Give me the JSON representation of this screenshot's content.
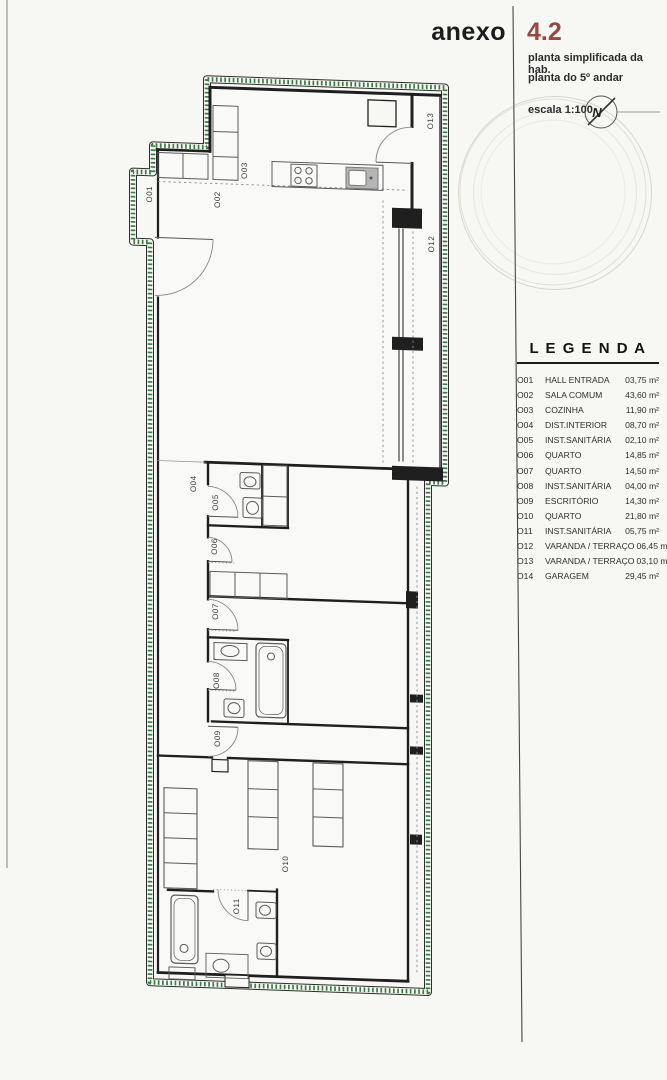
{
  "header": {
    "anexo_label": "anexo",
    "anexo_number": "4.2",
    "subtitle1": "planta simplificada da hab.",
    "subtitle2": "planta do 5º andar",
    "scale": "escala 1:100",
    "north_letter": "N",
    "accent_color": "#9b4741"
  },
  "legend": {
    "title": "L E G E N D A",
    "items": [
      {
        "code": "O01",
        "name": "HALL ENTRADA",
        "area": "03,75 m²"
      },
      {
        "code": "O02",
        "name": "SALA COMUM",
        "area": "43,60 m²"
      },
      {
        "code": "O03",
        "name": "COZINHA",
        "area": "11,90 m²"
      },
      {
        "code": "O04",
        "name": "DIST.INTERIOR",
        "area": "08,70 m²"
      },
      {
        "code": "O05",
        "name": "INST.SANITÁRIA",
        "area": "02,10 m²"
      },
      {
        "code": "O06",
        "name": "QUARTO",
        "area": "14,85 m²"
      },
      {
        "code": "O07",
        "name": "QUARTO",
        "area": "14,50 m²"
      },
      {
        "code": "O08",
        "name": "INST.SANITÁRIA",
        "area": "04,00 m²"
      },
      {
        "code": "O09",
        "name": "ESCRITÓRIO",
        "area": "14,30 m²"
      },
      {
        "code": "O10",
        "name": "QUARTO",
        "area": "21,80 m²"
      },
      {
        "code": "O11",
        "name": "INST.SANITÁRIA",
        "area": "05,75 m²"
      },
      {
        "code": "O12",
        "name": "VARANDA / TERRAÇO",
        "area": "06,45 m²"
      },
      {
        "code": "O13",
        "name": "VARANDA / TERRAÇO",
        "area": "03,10 m²"
      },
      {
        "code": "O14",
        "name": "GARAGEM",
        "area": "29,45 m²"
      }
    ]
  },
  "plan": {
    "boundary_color": "#3e7b4a",
    "labels": [
      {
        "text": "O01"
      },
      {
        "text": "O02"
      },
      {
        "text": "O03"
      },
      {
        "text": "O04"
      },
      {
        "text": "O05"
      },
      {
        "text": "O06"
      },
      {
        "text": "O07"
      },
      {
        "text": "O08"
      },
      {
        "text": "O09"
      },
      {
        "text": "O10"
      },
      {
        "text": "O11"
      },
      {
        "text": "O12"
      },
      {
        "text": "O13"
      }
    ]
  }
}
